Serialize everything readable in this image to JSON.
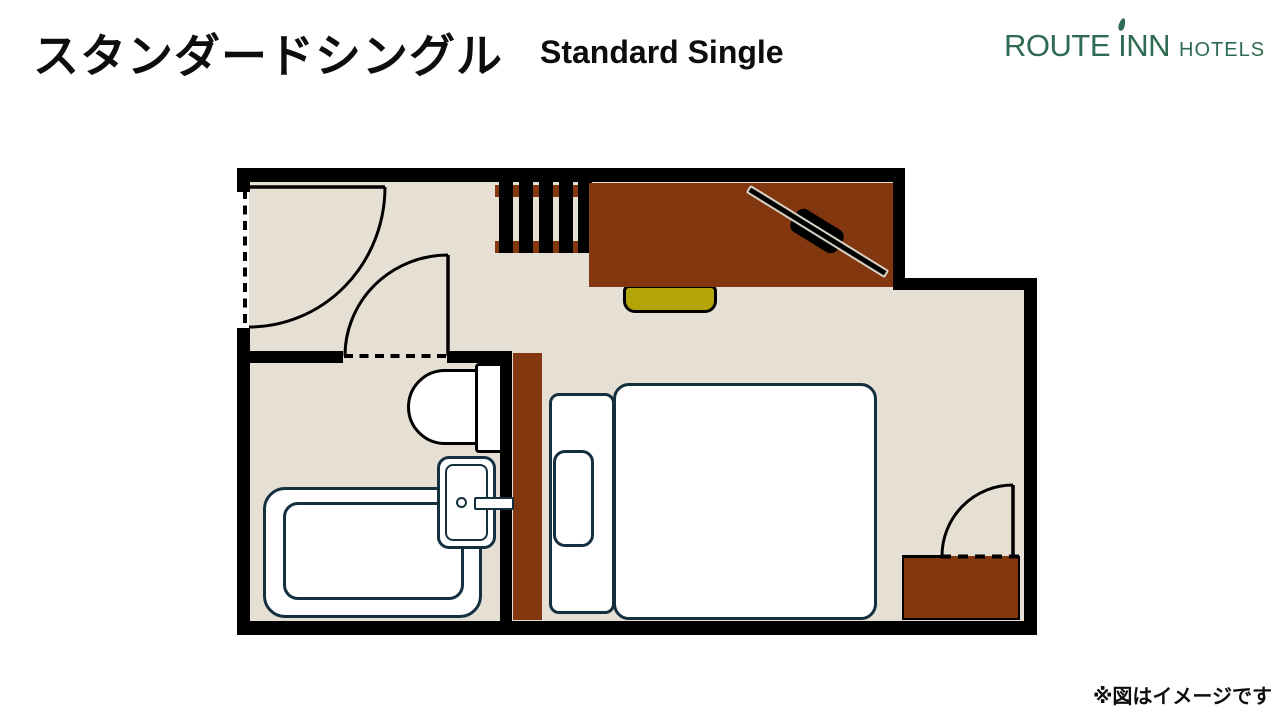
{
  "header": {
    "title_jp": "スタンダードシングル",
    "title_en": "Standard Single"
  },
  "logo": {
    "brand_pre": "ROUTE ",
    "brand_accent_letter": "I",
    "brand_post": "NN",
    "suffix": "HOTELS"
  },
  "footer": {
    "disclaimer": "※図はイメージです"
  },
  "colors": {
    "floor": "#e6dfd4",
    "wall": "#000000",
    "wood": "#83370f",
    "chair": "#b3a408",
    "outline": "#14303f",
    "logo-green": "#2e6b50",
    "text": "#0d0d0d"
  },
  "floorplan": {
    "room_type": "standard-single",
    "rooms": [
      "entry",
      "bathroom",
      "bedroom"
    ],
    "elements": [
      "entrance-door",
      "hanger-rack",
      "desk",
      "tv",
      "chair",
      "bed",
      "headboard",
      "pillow",
      "nightstand-cabinet",
      "toilet",
      "sink",
      "bathtub",
      "bathroom-door",
      "room-side-door",
      "cabinet-fridge"
    ]
  }
}
